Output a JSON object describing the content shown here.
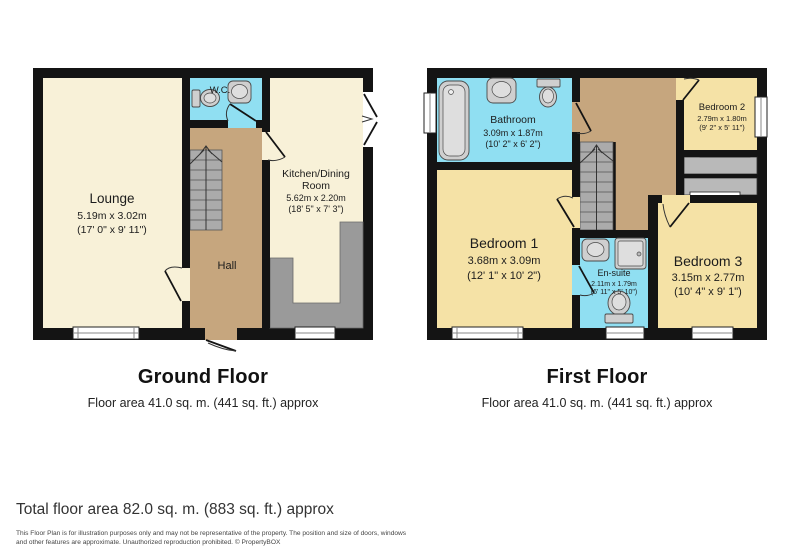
{
  "ground_floor": {
    "title": "Ground Floor",
    "subtitle": "Floor area 41.0 sq. m. (441 sq. ft.) approx",
    "rooms": {
      "lounge": {
        "name": "Lounge",
        "dims_m": "5.19m x 3.02m",
        "dims_ft": "(17' 0\" x 9' 11\")"
      },
      "wc": {
        "name": "W.C."
      },
      "hall": {
        "name": "Hall"
      },
      "kitchen": {
        "name_line1": "Kitchen/Dining",
        "name_line2": "Room",
        "dims_m": "5.62m x 2.20m",
        "dims_ft": "(18' 5\" x 7' 3\")"
      }
    }
  },
  "first_floor": {
    "title": "First Floor",
    "subtitle": "Floor area 41.0 sq. m. (441 sq. ft.) approx",
    "rooms": {
      "bathroom": {
        "name": "Bathroom",
        "dims_m": "3.09m x 1.87m",
        "dims_ft": "(10' 2\" x 6' 2\")"
      },
      "bedroom1": {
        "name": "Bedroom 1",
        "dims_m": "3.68m x 3.09m",
        "dims_ft": "(12' 1\" x 10' 2\")"
      },
      "bedroom2": {
        "name": "Bedroom 2",
        "dims_m": "2.79m x 1.80m",
        "dims_ft": "(9' 2\" x 5' 11\")"
      },
      "bedroom3": {
        "name": "Bedroom 3",
        "dims_m": "3.15m x 2.77m",
        "dims_ft": "(10' 4\" x 9' 1\")"
      },
      "ensuite": {
        "name": "En-suite",
        "dims_m": "2.11m x 1.79m",
        "dims_ft": "(6' 11\" x 5' 10\")"
      }
    }
  },
  "footer": {
    "total": "Total floor area 82.0 sq. m. (883 sq. ft.) approx",
    "disclaimer_line1": "This Floor Plan is for illustration purposes only and may not be representative of the property. The position and size of doors, windows",
    "disclaimer_line2": "and other features are approximate. Unauthorized reproduction prohibited. © PropertyBOX"
  },
  "colors": {
    "wall": "#141414",
    "cream_room": "#F8F1D8",
    "yellow_room": "#F5E2A6",
    "wet_room_cyan": "#90DFF2",
    "hall_tan": "#C6A67E",
    "stairs_gray": "#ABABAB",
    "counter_gray": "#9A9A9A",
    "cupboard_gray": "#B9B9B9"
  }
}
